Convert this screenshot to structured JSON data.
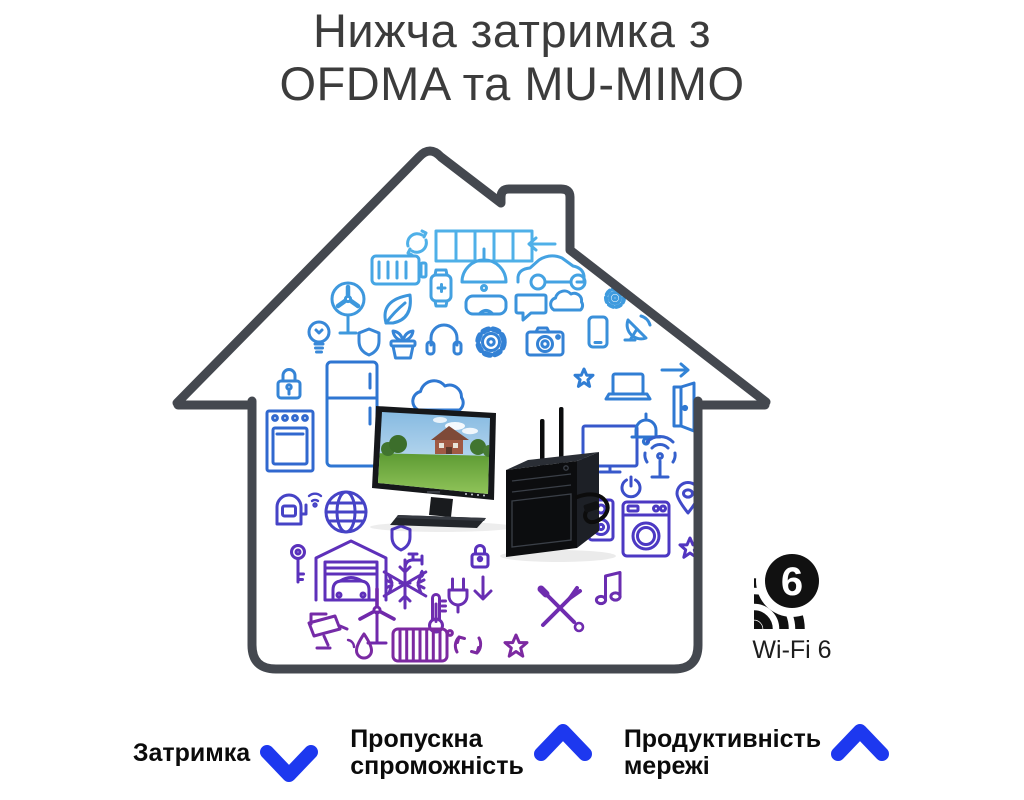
{
  "title": {
    "line1": "Нижча затримка з",
    "line2": "OFDMA та MU-MIMO"
  },
  "wifi_badge": {
    "number": "6",
    "label": "Wi-Fi 6"
  },
  "metrics": [
    {
      "name": "latency",
      "lines": [
        "Затримка"
      ],
      "trend": "down"
    },
    {
      "name": "throughput",
      "lines": [
        "Пропускна",
        "спроможність"
      ],
      "trend": "up"
    },
    {
      "name": "network-performance",
      "lines": [
        "Продуктивність",
        "мережі"
      ],
      "trend": "up"
    }
  ],
  "colors": {
    "arrow_blue": "#1d38ef",
    "house_outline": "#44484f",
    "icon_gradient_top": "#4fb0e8",
    "icon_gradient_mid": "#2e73d0",
    "icon_gradient_bottom": "#7c29a1",
    "wifi_logo_black": "#111111",
    "title_text": "#3c3c3c",
    "label_text": "#0b0b0b"
  },
  "house_icons": [
    "sync-icon",
    "solar-panel-icon",
    "pendant-lamp-icon",
    "arrow-left-icon",
    "battery-icon",
    "car-icon",
    "smartwatch-icon",
    "gear-small-icon",
    "fan-icon",
    "leaf-icon",
    "vr-glasses-icon",
    "chat-bubble-icon",
    "cloud-small-icon",
    "phone-icon",
    "satellite-dish-icon",
    "lightbulb-icon",
    "shield-icon",
    "plant-pot-icon",
    "headphones-icon",
    "cloud-big-icon",
    "gear-icon",
    "camera-icon",
    "star-small-icon",
    "lock-icon",
    "fridge-icon",
    "oven-icon",
    "tv-icon",
    "laptop-icon",
    "arrow-right-icon",
    "open-door-icon",
    "bell-icon",
    "wifi-antenna-icon",
    "power-button-icon",
    "mailbox-icon",
    "globe-icon",
    "location-pin-icon",
    "washing-machine-icon",
    "speaker-icon",
    "star-icon",
    "key-icon",
    "faucet-icon",
    "garage-car-icon",
    "shield-check-icon",
    "padlock-small-icon",
    "snowflake-icon",
    "thermometer-icon",
    "plug-icon",
    "arrow-down-small-icon",
    "tools-icon",
    "music-note-icon",
    "cctv-icon",
    "wind-turbine-icon",
    "droplet-icon",
    "radiator-icon",
    "recycle-icon",
    "star-outline-icon"
  ]
}
